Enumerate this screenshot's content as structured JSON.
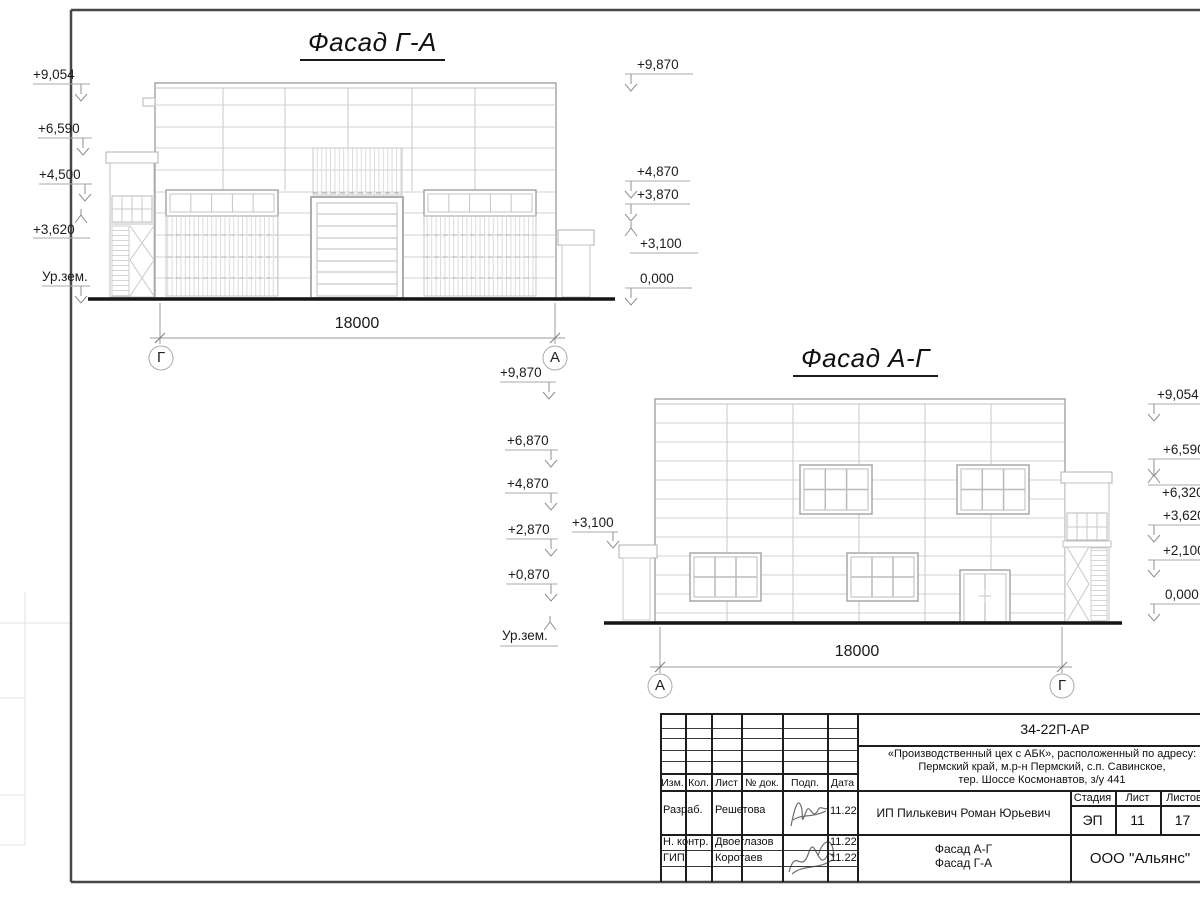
{
  "facade_ga": {
    "title": "Фасад Г-А",
    "dim": "18000",
    "axes": {
      "left": "Г",
      "right": "А"
    },
    "marks_left": [
      "+9,054",
      "+6,590",
      "+4,500",
      "+3,620",
      "Ур.зем."
    ],
    "marks_right": [
      "+9,870",
      "+4,870",
      "+3,870",
      "+3,100",
      "0,000"
    ]
  },
  "facade_ag": {
    "title": "Фасад А-Г",
    "dim": "18000",
    "axes": {
      "left": "А",
      "right": "Г"
    },
    "marks_left": [
      "+9,870",
      "+6,870",
      "+4,870",
      "+2,870",
      "+0,870",
      "Ур.зем."
    ],
    "mark_canopy": "+3,100",
    "marks_right": [
      "+9,054",
      "+6,590",
      "+6,320",
      "+3,620",
      "+2,100",
      "0,000"
    ]
  },
  "title_block": {
    "doc_code": "34-22П-АР",
    "project_line1": "«Производственный цех с АБК», расположенный по адресу:",
    "project_line2": "Пермский край, м.р-н Пермский, с.п. Савинское,",
    "project_line3": "тер. Шоссе Космонавтов, з/у 441",
    "client": "ИП Пилькевич Роман Юрьевич",
    "stage_label": "Стадия",
    "sheet_label": "Лист",
    "sheets_label": "Листов",
    "stage": "ЭП",
    "sheet_no": "11",
    "sheets_total": "17",
    "sheet_title_line1": "Фасад А-Г",
    "sheet_title_line2": "Фасад Г-А",
    "company": "ООО \"Альянс\"",
    "columns": [
      "Изм.",
      "Кол.",
      "Лист",
      "№ док.",
      "Подп.",
      "Дата"
    ],
    "rows": [
      {
        "role": "Разраб.",
        "name": "Решетова",
        "date": "11.22"
      },
      {
        "role": "Н. контр.",
        "name": "Двоеглазов",
        "date": "11.22"
      },
      {
        "role": "ГИП",
        "name": "Коротаев",
        "date": "11.22"
      }
    ]
  }
}
